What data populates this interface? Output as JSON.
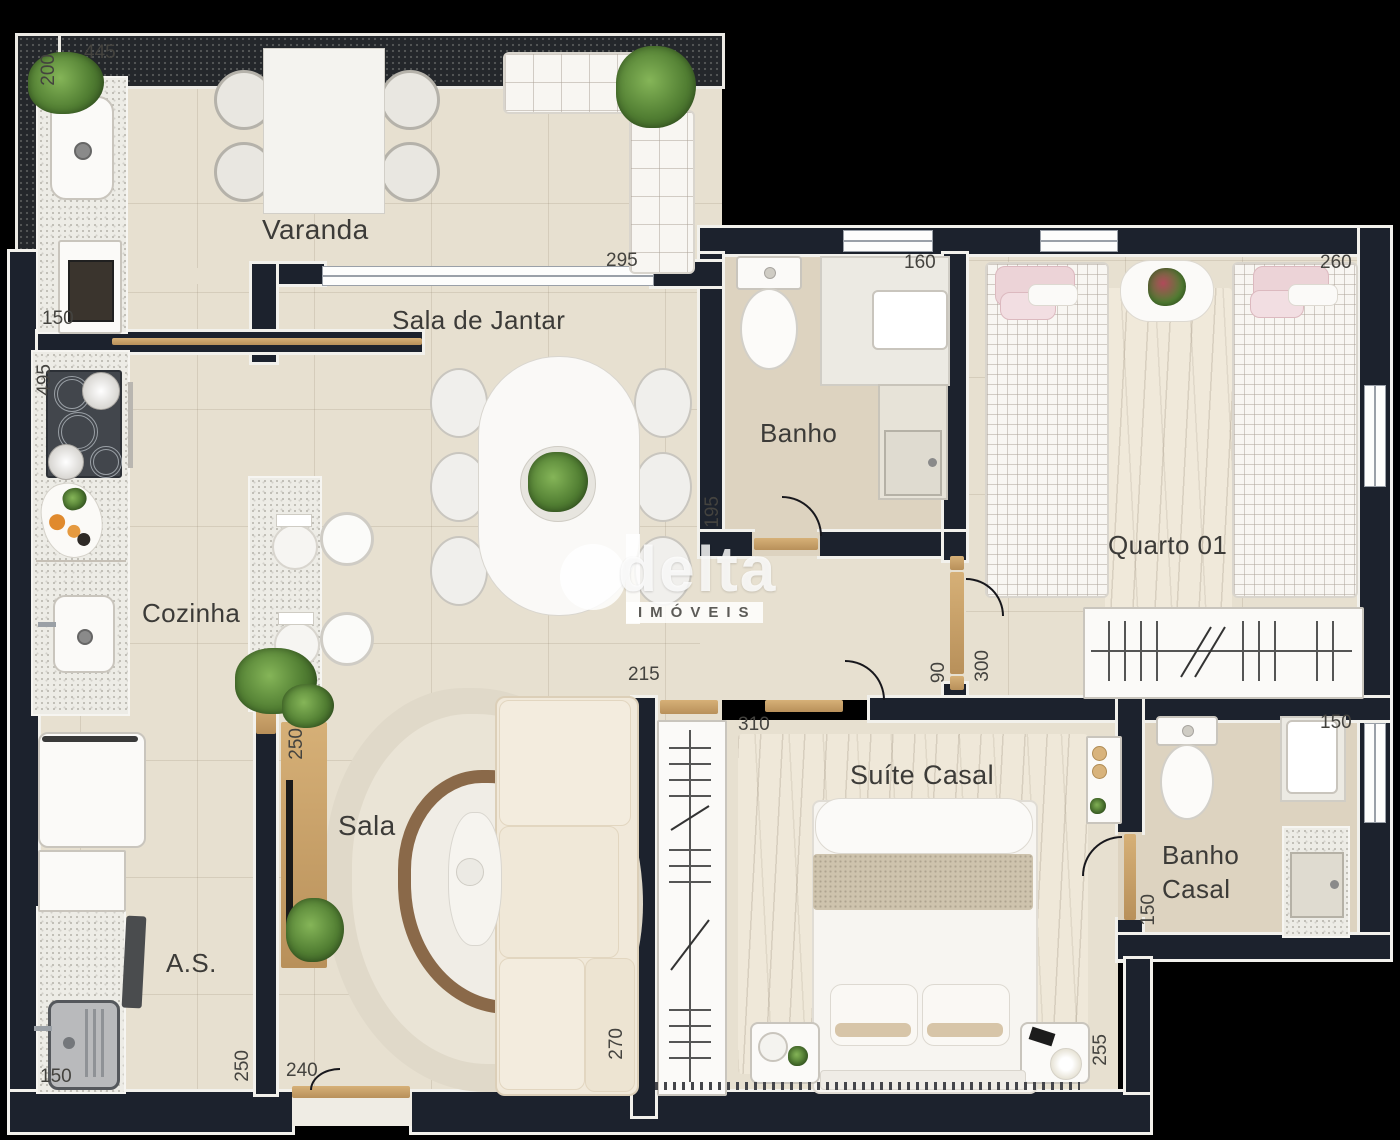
{
  "watermark": {
    "brand": "delta",
    "subtitle": "IMÓVEIS"
  },
  "rooms": {
    "varanda": "Varanda",
    "sala_de_jantar": "Sala de Jantar",
    "banho": "Banho",
    "quarto01": "Quarto 01",
    "cozinha": "Cozinha",
    "sala": "Sala",
    "area_servico": "A.S.",
    "suite_casal": "Suíte Casal",
    "banho_casal_line1": "Banho",
    "banho_casal_line2": "Casal"
  },
  "dimensions_cm": {
    "varanda_left": "200",
    "varanda_top": "445",
    "varanda_right": "135",
    "varanda_bottom": "295",
    "kitchen_pass": "150",
    "cozinha_left": "495",
    "banho_top": "160",
    "banho_left": "195",
    "quarto01_top": "260",
    "jantar_bottom": "215",
    "hall_width": "90",
    "quarto01_entry": "300",
    "suite_top": "310",
    "sala_console": "250",
    "servico_right": "250",
    "servico_bottom": "150",
    "sala_bottom": "240",
    "sala_right": "270",
    "suite_right": "255",
    "banho_casal_top": "150",
    "banho_casal_left": "150"
  },
  "colors": {
    "background": "#000000",
    "wall": "#1c222d",
    "wall_trim": "#f2f1ec",
    "floor": "#e7e0d0",
    "floor_warm": "#ddd3c0",
    "granite": "#edece6",
    "wood": "#c8a061",
    "sofa": "#f1e9da",
    "rug_ring": "#8a6949",
    "plant_green": "#4e7d33",
    "pillow_pink": "#ecd4d8"
  }
}
